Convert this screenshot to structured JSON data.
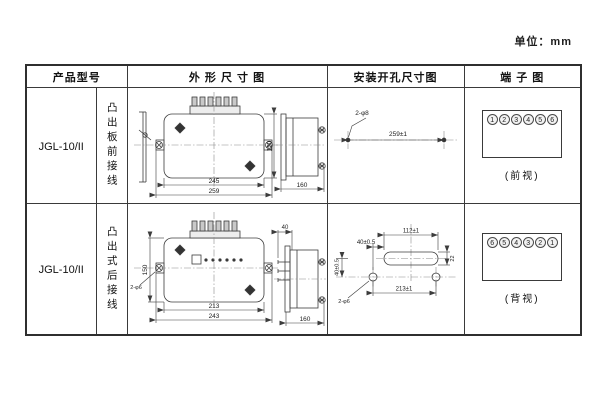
{
  "page": {
    "unit_label": "单位：mm"
  },
  "table": {
    "headers": [
      "产品型号",
      "外 形 尺 寸 图",
      "安装开孔尺寸图",
      "端 子 图"
    ],
    "rows": [
      {
        "model": "JGL-10/II",
        "wiring": "凸出板前接线",
        "outline": {
          "width_inner": "245",
          "width_outer": "259",
          "height": "150",
          "depth": "160"
        },
        "install": {
          "holes_label": "2-φ8",
          "span": "259±1"
        },
        "terminal": {
          "numbers": [
            "1",
            "2",
            "3",
            "4",
            "5",
            "6"
          ],
          "caption": "(前视)"
        }
      },
      {
        "model": "JGL-10/II",
        "wiring": "凸出式后接线",
        "outline": {
          "width_inner": "213",
          "width_outer": "243",
          "height": "150",
          "depth": "160",
          "top_depth": "40",
          "ear_holes_label": "2-φ6"
        },
        "install": {
          "slot_width": "112±1",
          "offset_h": "40±0.5",
          "offset_v": "40±0.5",
          "slot_height": "22",
          "span": "213±1",
          "holes_label": "2-φ6"
        },
        "terminal": {
          "numbers": [
            "6",
            "5",
            "4",
            "3",
            "2",
            "1"
          ],
          "caption": "(背视)"
        }
      }
    ]
  }
}
